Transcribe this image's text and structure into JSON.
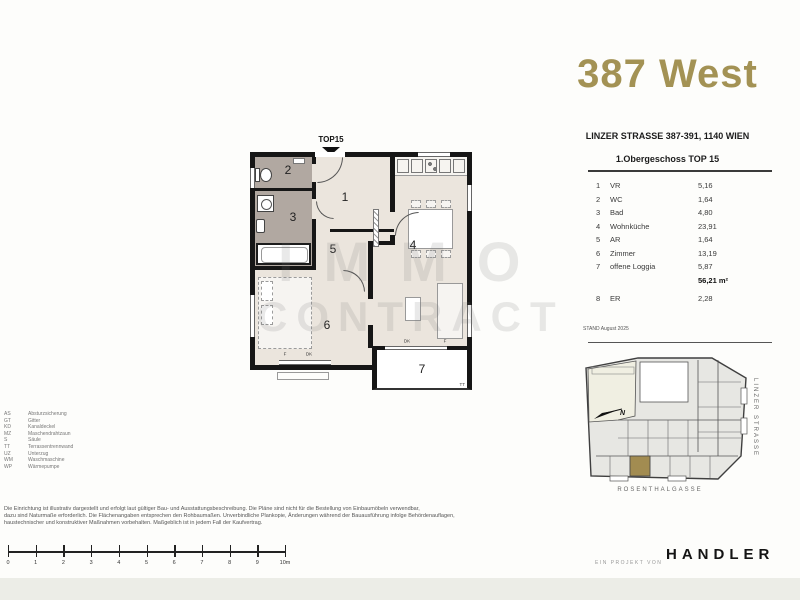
{
  "title": {
    "text": "387 West"
  },
  "colors": {
    "accent_gold": "#a39254",
    "map_highlight": "#a28c51",
    "floor_cream": "#ebe5dd",
    "floor_wet": "#b1a8a1",
    "footer_band": "#ecede7"
  },
  "project": {
    "address": "LINZER STRASSE 387-391, 1140 WIEN",
    "floor_title": "1.Obergeschoss TOP 15",
    "stand": "STAND August 2025"
  },
  "room_table": {
    "rows": [
      {
        "nr": "1",
        "name": "VR",
        "area": "5,16"
      },
      {
        "nr": "2",
        "name": "WC",
        "area": "1,64"
      },
      {
        "nr": "3",
        "name": "Bad",
        "area": "4,80"
      },
      {
        "nr": "4",
        "name": "Wohnküche",
        "area": "23,91"
      },
      {
        "nr": "5",
        "name": "AR",
        "area": "1,64"
      },
      {
        "nr": "6",
        "name": "Zimmer",
        "area": "13,19"
      },
      {
        "nr": "7",
        "name": "offene Loggia",
        "area": "5,87"
      }
    ],
    "total": "56,21 m²",
    "extra_row": {
      "nr": "8",
      "name": "ER",
      "area": "2,28"
    }
  },
  "plan": {
    "top_label": "TOP15",
    "room_labels": [
      "1",
      "2",
      "3",
      "4",
      "5",
      "6",
      "7"
    ],
    "marks": {
      "f1": "F",
      "dk1": "DK",
      "dk2": "DK",
      "f2": "F",
      "tt": "TT"
    }
  },
  "watermark": {
    "line1": "IMMO",
    "line2": "CONTRACT"
  },
  "legend": {
    "items": [
      {
        "abbr": "AS",
        "term": "Absturzsicherung"
      },
      {
        "abbr": "GT",
        "term": "Gitter"
      },
      {
        "abbr": "KD",
        "term": "Kanaldeckel"
      },
      {
        "abbr": "MZ",
        "term": "Maschendrahtzaun"
      },
      {
        "abbr": "S",
        "term": "Säule"
      },
      {
        "abbr": "TT",
        "term": "Terrassentrennwand"
      },
      {
        "abbr": "UZ",
        "term": "Unterzug"
      },
      {
        "abbr": "WM",
        "term": "Waschmaschine"
      },
      {
        "abbr": "WP",
        "term": "Wärmepumpe"
      }
    ]
  },
  "disclaimer": {
    "line1": "Die Einrichtung ist illustrativ dargestellt und erfolgt laut gültiger Bau- und Ausstattungsbeschreibung. Die Pläne sind nicht für die Bestellung von Einbaumöbeln verwendbar,",
    "line2": "dazu sind Naturmaße erforderlich. Die Flächenangaben entsprechen den Rohbaumaßen. Unverbindliche Plankopie, Änderungen während der Bauausführung infolge Behördenauflagen,",
    "line3": "haustechnischer und konstruktiver Maßnahmen vorbehalten. Maßgeblich ist in jedem Fall der Kaufvertrag."
  },
  "scalebar": {
    "labels": [
      "0",
      "1",
      "2",
      "3",
      "4",
      "5",
      "6",
      "7",
      "8",
      "9",
      "10m"
    ]
  },
  "map": {
    "street_right": "LINZER STRASSE",
    "street_bottom": "ROSENTHALGASSE",
    "north": "N"
  },
  "footer": {
    "prefix": "EIN PROJEKT VON",
    "brand": "HANDLER"
  }
}
